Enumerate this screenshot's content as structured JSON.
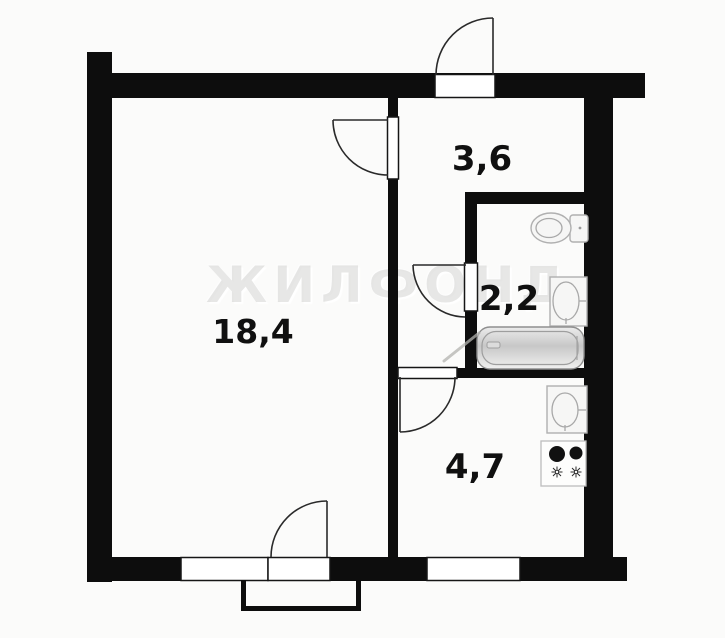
{
  "watermark": "ЖИЛФОНД",
  "rooms": [
    {
      "name": "living-room",
      "area": "18,4"
    },
    {
      "name": "hallway",
      "area": "3,6"
    },
    {
      "name": "bathroom",
      "area": "2,2"
    },
    {
      "name": "kitchen",
      "area": "4,7"
    }
  ],
  "fixtures": [
    "entrance-door",
    "living-room-door",
    "bathroom-door",
    "kitchen-door",
    "balcony-door",
    "window",
    "kitchen-window",
    "balcony",
    "toilet",
    "bathroom-sink",
    "bathtub",
    "kitchen-sink",
    "stove"
  ],
  "colors": {
    "wall": "#0d0d0d",
    "background": "#fbfbfa",
    "label": "#101010",
    "fixture_outline": "#b0b0b0",
    "watermark_gray": "#78786f"
  }
}
